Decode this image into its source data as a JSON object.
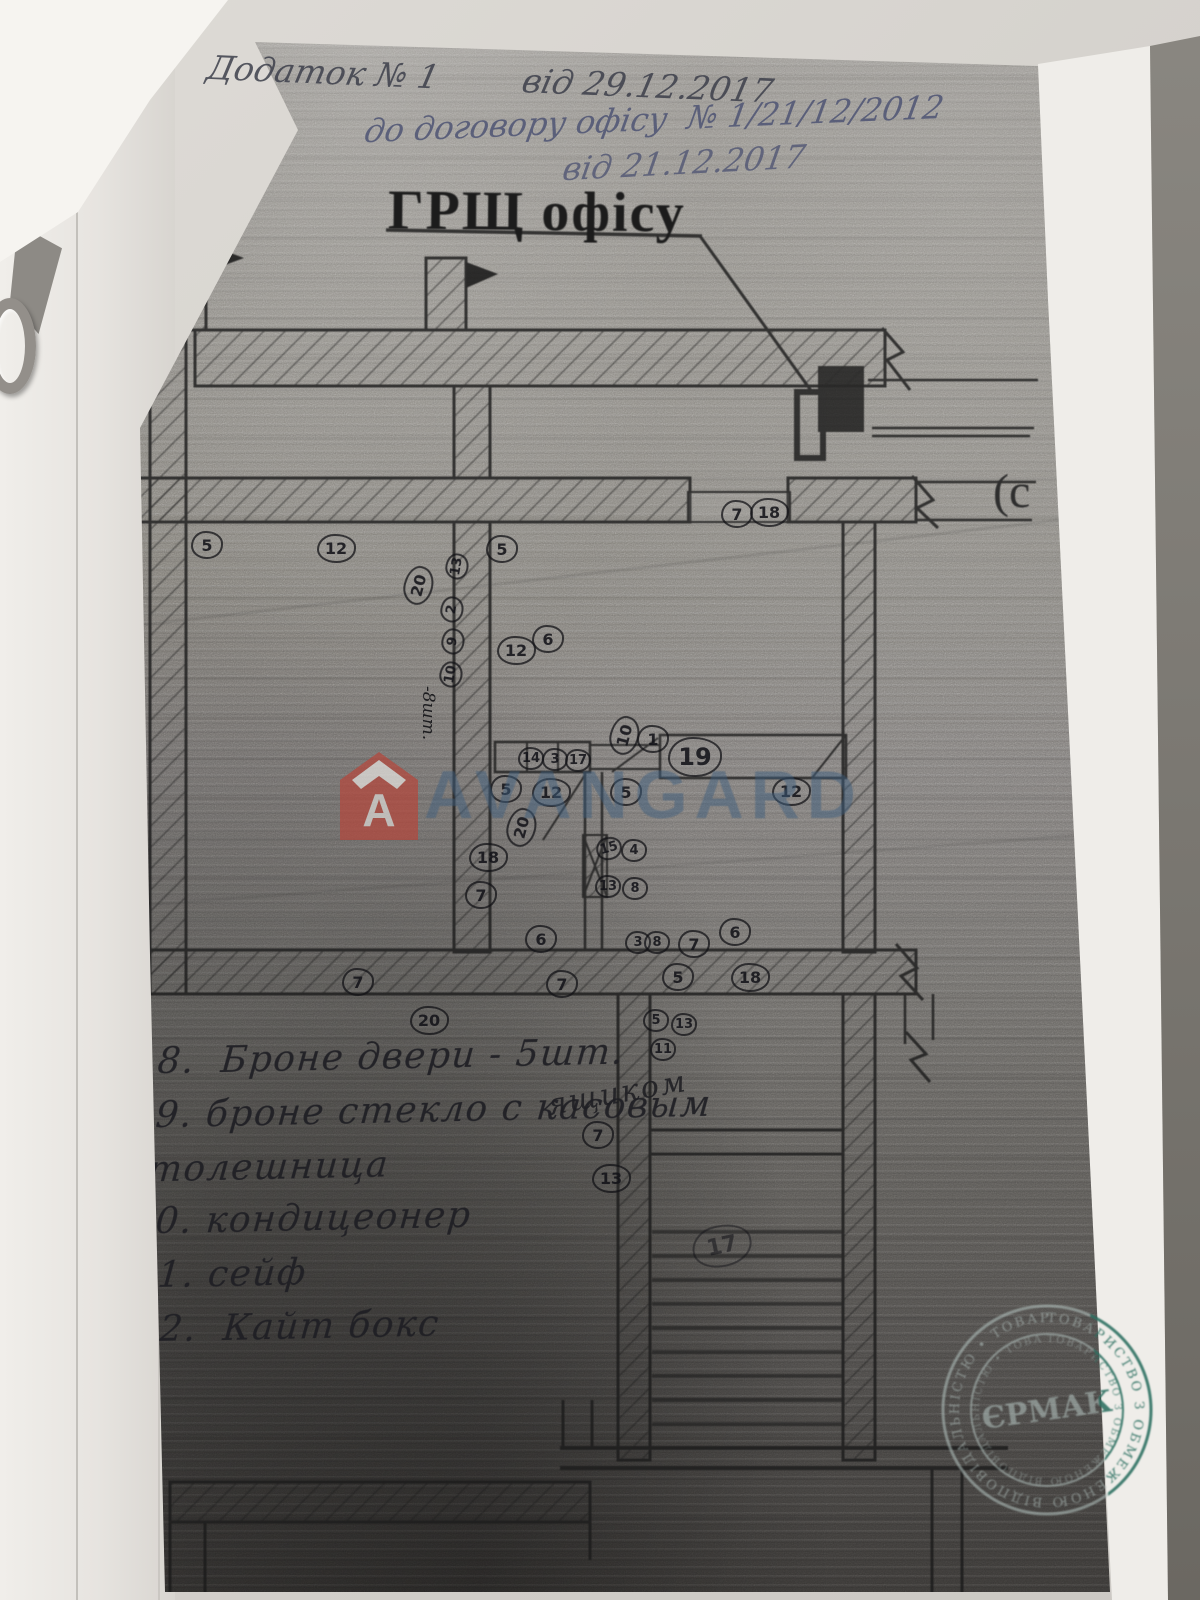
{
  "header": {
    "line1": "Додаток № 1        від 29.12.2017",
    "line2": "до договору офісу  № 1/21/12/2012",
    "line3": "від 21.12.2017"
  },
  "plan": {
    "title": "ГРЩ офісу",
    "side_fragment": "(с",
    "notes": {
      "count_8": "-8шт.",
      "yashchikom": "ящиком"
    },
    "markers": [
      {
        "x": 207,
        "y": 545,
        "n": "5"
      },
      {
        "x": 336,
        "y": 548,
        "n": "12"
      },
      {
        "x": 502,
        "y": 549,
        "n": "5"
      },
      {
        "x": 418,
        "y": 585,
        "n": "20",
        "r": -75
      },
      {
        "x": 457,
        "y": 566,
        "n": "13",
        "s": "sm",
        "r": -80
      },
      {
        "x": 452,
        "y": 609,
        "n": "2",
        "s": "sm",
        "r": -80
      },
      {
        "x": 453,
        "y": 641,
        "n": "9",
        "s": "sm",
        "r": -80
      },
      {
        "x": 451,
        "y": 674,
        "n": "10",
        "s": "sm",
        "r": -80
      },
      {
        "x": 737,
        "y": 514,
        "n": "7"
      },
      {
        "x": 769,
        "y": 512,
        "n": "18"
      },
      {
        "x": 516,
        "y": 650,
        "n": "12"
      },
      {
        "x": 548,
        "y": 639,
        "n": "6"
      },
      {
        "x": 624,
        "y": 735,
        "n": "10",
        "r": -75
      },
      {
        "x": 653,
        "y": 739,
        "n": "1"
      },
      {
        "x": 531,
        "y": 758,
        "n": "14",
        "s": "sm"
      },
      {
        "x": 555,
        "y": 759,
        "n": "3",
        "s": "sm"
      },
      {
        "x": 578,
        "y": 760,
        "n": "17",
        "s": "sm"
      },
      {
        "x": 506,
        "y": 789,
        "n": "5"
      },
      {
        "x": 551,
        "y": 792,
        "n": "12"
      },
      {
        "x": 626,
        "y": 792,
        "n": "5"
      },
      {
        "x": 791,
        "y": 791,
        "n": "12"
      },
      {
        "x": 521,
        "y": 827,
        "n": "20",
        "r": -75
      },
      {
        "x": 488,
        "y": 857,
        "n": "18"
      },
      {
        "x": 481,
        "y": 895,
        "n": "7"
      },
      {
        "x": 609,
        "y": 848,
        "n": "15",
        "s": "sm",
        "r": -15
      },
      {
        "x": 634,
        "y": 850,
        "n": "4",
        "s": "sm"
      },
      {
        "x": 608,
        "y": 886,
        "n": "13",
        "s": "sm"
      },
      {
        "x": 635,
        "y": 888,
        "n": "8",
        "s": "sm"
      },
      {
        "x": 541,
        "y": 939,
        "n": "6"
      },
      {
        "x": 638,
        "y": 942,
        "n": "3",
        "s": "sm"
      },
      {
        "x": 657,
        "y": 942,
        "n": "8",
        "s": "sm"
      },
      {
        "x": 694,
        "y": 944,
        "n": "7"
      },
      {
        "x": 735,
        "y": 932,
        "n": "6"
      },
      {
        "x": 358,
        "y": 982,
        "n": "7"
      },
      {
        "x": 562,
        "y": 984,
        "n": "7"
      },
      {
        "x": 678,
        "y": 977,
        "n": "5"
      },
      {
        "x": 750,
        "y": 977,
        "n": "18"
      },
      {
        "x": 429,
        "y": 1020,
        "n": "20"
      },
      {
        "x": 656,
        "y": 1020,
        "n": "5",
        "s": "sm"
      },
      {
        "x": 684,
        "y": 1024,
        "n": "13",
        "s": "sm"
      },
      {
        "x": 663,
        "y": 1049,
        "n": "11",
        "s": "sm"
      },
      {
        "x": 598,
        "y": 1135,
        "n": "7"
      },
      {
        "x": 611,
        "y": 1178,
        "n": "13"
      },
      {
        "x": 722,
        "y": 1246,
        "n": "17",
        "s": "xl",
        "r": -12,
        "o": 0.55
      },
      {
        "x": 695,
        "y": 757,
        "n": "19",
        "s": "lg"
      }
    ]
  },
  "legend": {
    "lines": [
      "18.  Броне двери - 5шт.",
      "19. броне стекло с касовым",
      "столешница",
      "20. кондицеонер",
      "21. сейф",
      "22.  Кайт бокс"
    ]
  },
  "watermark": {
    "brand": "AVANGARD",
    "logo_letter": "A",
    "brand_color": "#b5473c",
    "text_color": "#3e5e7e"
  },
  "stamp": {
    "ring_text": "ТОВАРИСТВО З ОБМЕЖЕНОЮ ВІДПОВІДАЛЬНІСТЮ • ТОВАРИСТВО З ОБ",
    "center_text": "ЄРМАК",
    "color_on_copy": "#b7c6c3",
    "color_on_paper": "#2f7263"
  },
  "colors": {
    "ink_blue": "#4e5474",
    "pencil_graphite": "#3c3f4a",
    "plan_line": "#1b1b1b"
  }
}
